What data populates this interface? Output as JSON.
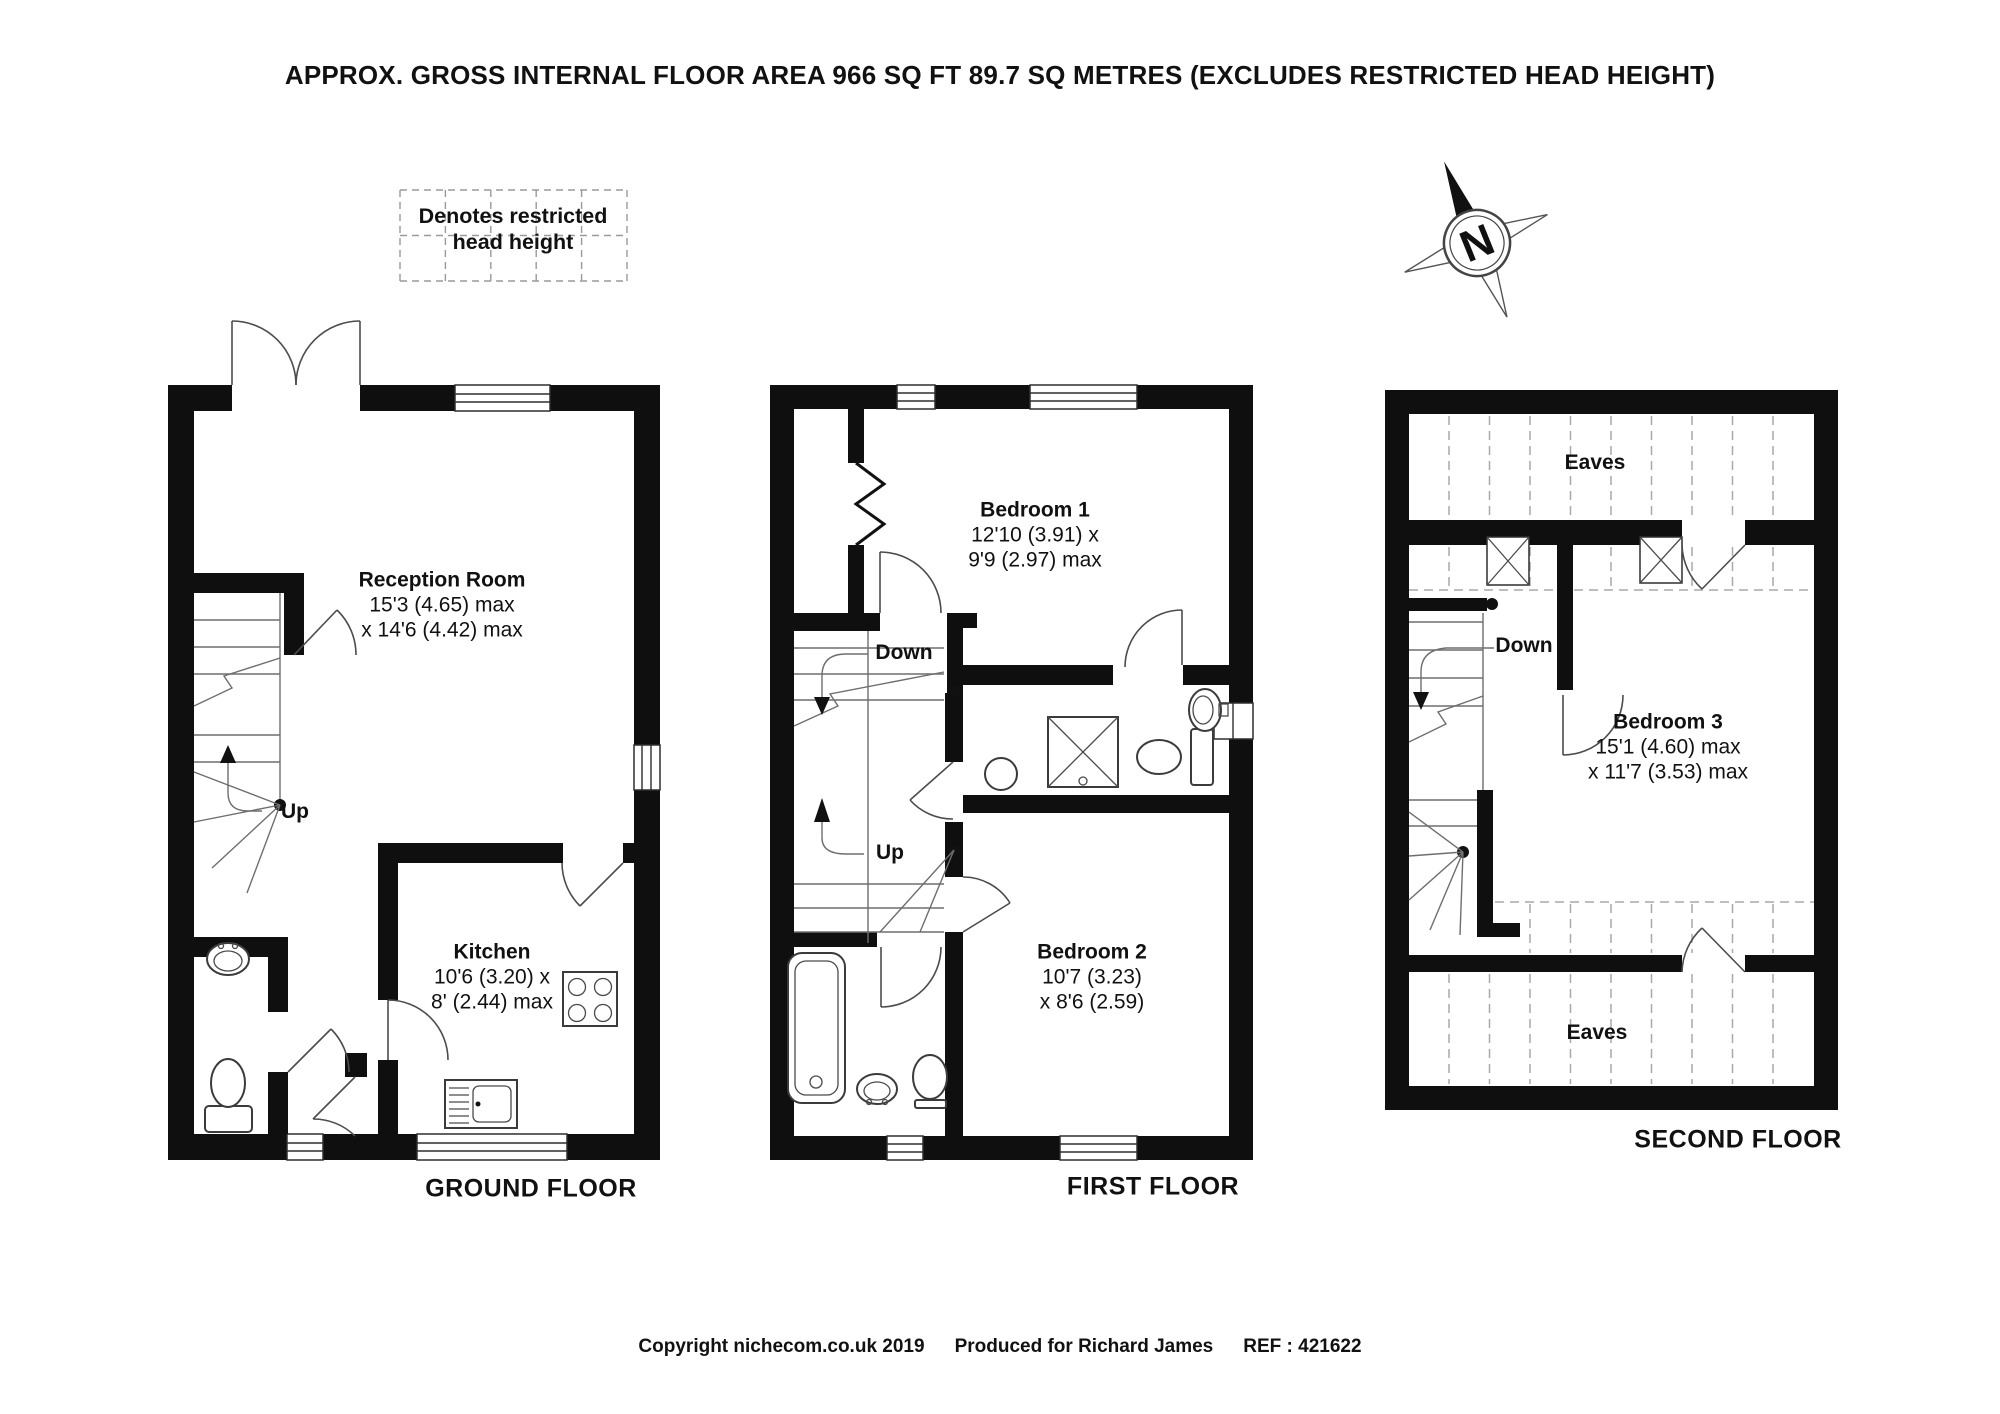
{
  "title": "APPROX. GROSS INTERNAL FLOOR AREA 966 SQ FT 89.7 SQ METRES (EXCLUDES RESTRICTED HEAD HEIGHT)",
  "legend": {
    "text": "Denotes restricted head height"
  },
  "compass": {
    "direction": "N"
  },
  "floors": {
    "ground": {
      "caption": "GROUND FLOOR",
      "stair_label": "Up",
      "rooms": {
        "reception": {
          "name": "Reception Room",
          "dim_line1": "15'3 (4.65) max",
          "dim_line2": "x 14'6 (4.42) max"
        },
        "kitchen": {
          "name": "Kitchen",
          "dim_line1": "10'6 (3.20) x",
          "dim_line2": "8' (2.44) max"
        }
      }
    },
    "first": {
      "caption": "FIRST FLOOR",
      "stair_down_label": "Down",
      "stair_up_label": "Up",
      "rooms": {
        "bedroom1": {
          "name": "Bedroom 1",
          "dim_line1": "12'10 (3.91) x",
          "dim_line2": "9'9 (2.97) max"
        },
        "bedroom2": {
          "name": "Bedroom 2",
          "dim_line1": "10'7 (3.23)",
          "dim_line2": "x 8'6 (2.59)"
        }
      }
    },
    "second": {
      "caption": "SECOND FLOOR",
      "stair_down_label": "Down",
      "eaves_top_label": "Eaves",
      "eaves_bottom_label": "Eaves",
      "rooms": {
        "bedroom3": {
          "name": "Bedroom 3",
          "dim_line1": "15'1 (4.60) max",
          "dim_line2": "x 11'7 (3.53) max"
        }
      }
    }
  },
  "footer": {
    "copyright": "Copyright nichecom.co.uk 2019",
    "produced_for": "Produced for Richard James",
    "ref": "REF :  421622"
  }
}
